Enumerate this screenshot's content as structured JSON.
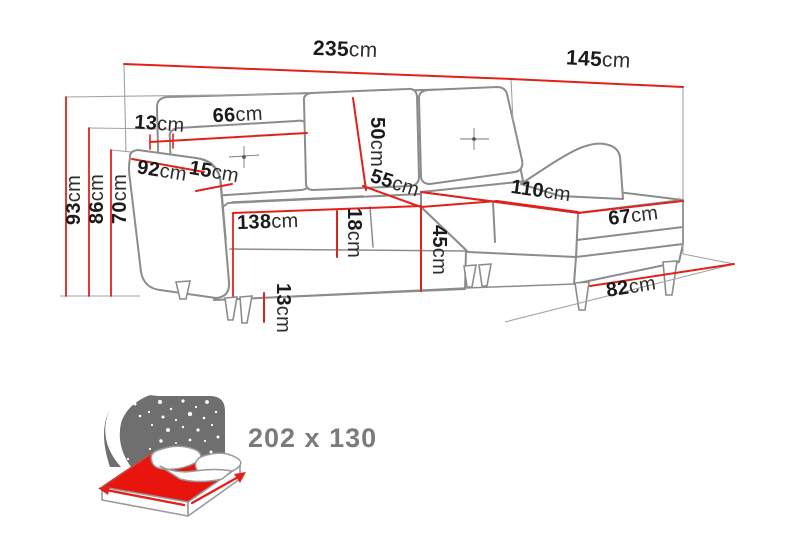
{
  "diagram": {
    "title_hint": "corner sofa dimension drawing",
    "colors": {
      "dimension_line": "#e3211b",
      "outline_gray": "#8c8c8c",
      "label_black": "#1b1b1b",
      "icon_panel_gray": "#6f6f6f",
      "size_text_gray": "#7b7b7b"
    },
    "dims": {
      "total_width": {
        "value": "235",
        "unit": "cm"
      },
      "total_depth": {
        "value": "145",
        "unit": "cm"
      },
      "total_height": {
        "value": "93",
        "unit": "cm"
      },
      "backrest_height": {
        "value": "86",
        "unit": "cm"
      },
      "armrest_height": {
        "value": "70",
        "unit": "cm"
      },
      "back_clearance": {
        "value": "13",
        "unit": "cm"
      },
      "back_cushion_width": {
        "value": "66",
        "unit": "cm"
      },
      "back_cushion_height": {
        "value": "50",
        "unit": "cm"
      },
      "armrest_length": {
        "value": "92",
        "unit": "cm"
      },
      "armrest_width": {
        "value": "15",
        "unit": "cm"
      },
      "seat_depth": {
        "value": "55",
        "unit": "cm"
      },
      "seat_width": {
        "value": "138",
        "unit": "cm"
      },
      "seat_cushion_height": {
        "value": "18",
        "unit": "cm"
      },
      "seat_height": {
        "value": "45",
        "unit": "cm"
      },
      "chaise_length": {
        "value": "110",
        "unit": "cm"
      },
      "chaise_width": {
        "value": "67",
        "unit": "cm"
      },
      "chaise_floor_length": {
        "value": "82",
        "unit": "cm"
      },
      "leg_height": {
        "value": "13",
        "unit": "cm"
      }
    },
    "sleeping_area": {
      "size_label": "202 x 130"
    }
  }
}
